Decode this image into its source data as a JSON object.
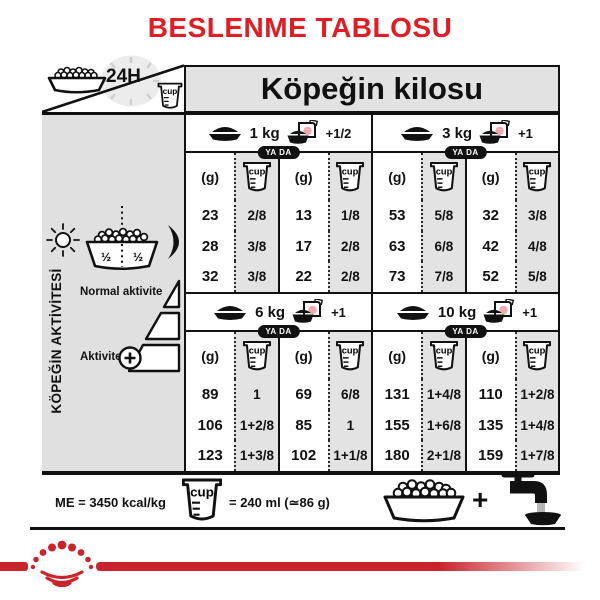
{
  "title": "BESLENME TABLOSU",
  "header": {
    "bowl_24h_label": "24H",
    "weight_header": "Köpeğin kilosu"
  },
  "sidebar": {
    "vertical_label": "KÖPEĞİN AKTİVİTESİ",
    "half_left": "½",
    "half_right": "½",
    "normal_label": "Normal aktivite",
    "active_label": "Aktivite"
  },
  "table": {
    "or_label": "YA DA",
    "unit_g": "(g)",
    "cup_label": "cup",
    "sections": [
      {
        "weight": "1 kg",
        "wet_add": "+1/2",
        "dry": {
          "g": [
            "23",
            "28",
            "32"
          ],
          "cup": [
            "2/8",
            "3/8",
            "3/8"
          ]
        },
        "dry_wet": {
          "g": [
            "13",
            "17",
            "22"
          ],
          "cup": [
            "1/8",
            "2/8",
            "2/8"
          ]
        }
      },
      {
        "weight": "3 kg",
        "wet_add": "+1",
        "dry": {
          "g": [
            "53",
            "63",
            "73"
          ],
          "cup": [
            "5/8",
            "6/8",
            "7/8"
          ]
        },
        "dry_wet": {
          "g": [
            "32",
            "42",
            "52"
          ],
          "cup": [
            "3/8",
            "4/8",
            "5/8"
          ]
        }
      },
      {
        "weight": "6 kg",
        "wet_add": "+1",
        "dry": {
          "g": [
            "89",
            "106",
            "123"
          ],
          "cup": [
            "1",
            "1+2/8",
            "1+3/8"
          ]
        },
        "dry_wet": {
          "g": [
            "69",
            "85",
            "102"
          ],
          "cup": [
            "6/8",
            "1",
            "1+1/8"
          ]
        }
      },
      {
        "weight": "10 kg",
        "wet_add": "+1",
        "dry": {
          "g": [
            "131",
            "155",
            "180"
          ],
          "cup": [
            "1+4/8",
            "1+6/8",
            "2+1/8"
          ]
        },
        "dry_wet": {
          "g": [
            "110",
            "135",
            "159"
          ],
          "cup": [
            "1+2/8",
            "1+4/8",
            "1+7/8"
          ]
        }
      }
    ]
  },
  "footer": {
    "me_text": "ME = 3450 kcal/kg",
    "cup_label": "cup",
    "cup_equiv": "= 240 ml (≃86 g)",
    "plus": "+"
  },
  "colors": {
    "accent_red": "#e01d25",
    "brand_red": "#c9242b",
    "panel_gray": "#e0e0e0"
  }
}
